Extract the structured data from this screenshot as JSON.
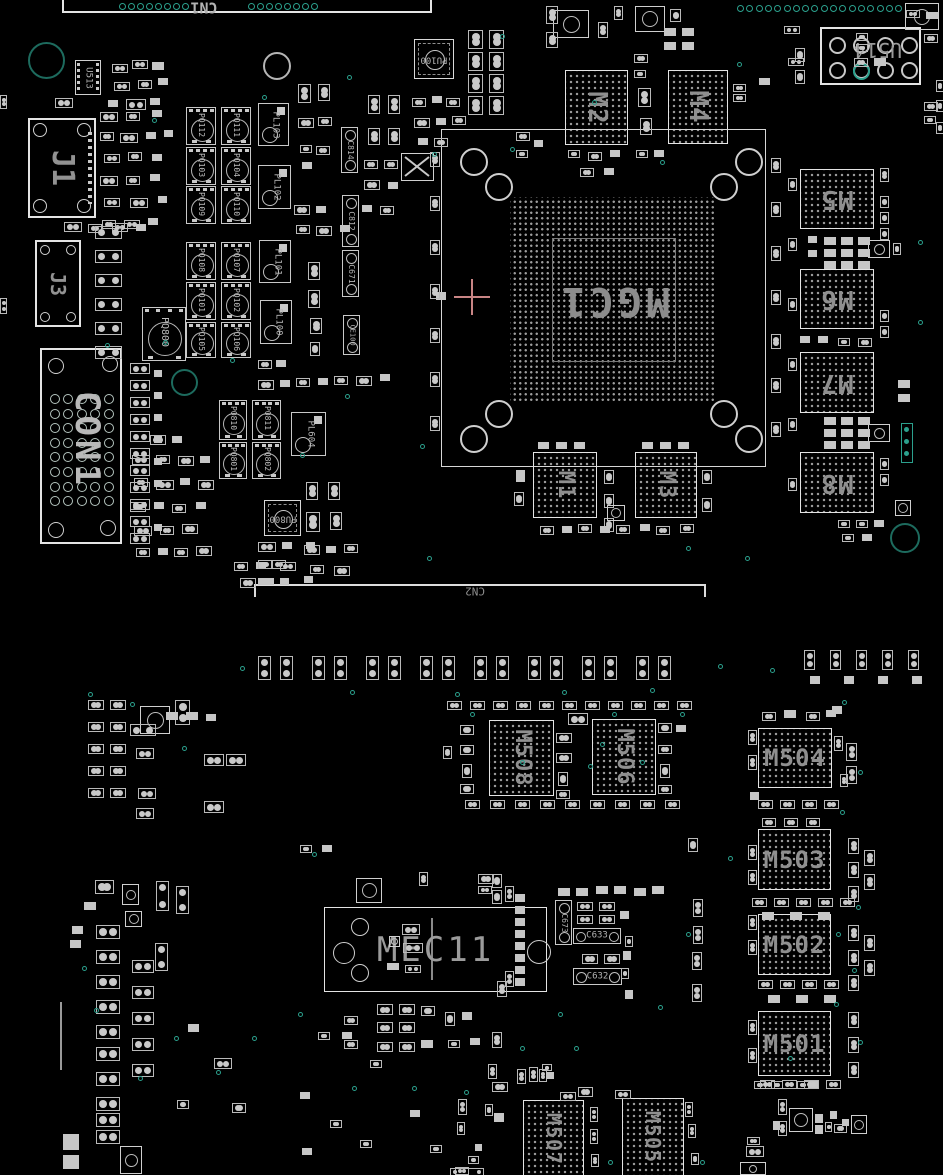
{
  "board": {
    "width": 943,
    "height": 1175,
    "description": "PCB boardview, black background, component outlines",
    "colors": {
      "background": "#000000",
      "outline": "#c8c8c8",
      "outline_bright": "#e4e4e4",
      "label": "#9a9a9a",
      "label_bright": "#b8b8b8",
      "pad_fill": "#c9c9c9",
      "bga_dot": "#9d9d9d",
      "teal": "#2ba08d",
      "teal_dim": "#1d6b5e",
      "crosshair": "#c98585"
    }
  },
  "components": [
    {
      "label": "CN1",
      "kind": "cn1"
    },
    {
      "label": "CN2",
      "kind": "cn2"
    },
    {
      "label": "U513",
      "kind": "soic",
      "x": 75,
      "y": 60,
      "w": 26,
      "h": 35,
      "rot": 90,
      "fs": 9
    },
    {
      "label": "J1",
      "kind": "jconn",
      "x": 28,
      "y": 118,
      "w": 68,
      "h": 100,
      "rot": 90,
      "fs": 30
    },
    {
      "label": "J3",
      "kind": "jconn",
      "x": 35,
      "y": 240,
      "w": 46,
      "h": 87,
      "rot": 90,
      "fs": 20
    },
    {
      "label": "CON1",
      "kind": "con1",
      "x": 40,
      "y": 348,
      "w": 82,
      "h": 196,
      "rot": 90,
      "fs": 34
    },
    {
      "label": "PU100",
      "kind": "qfn",
      "x": 414,
      "y": 39,
      "w": 40,
      "h": 40,
      "rot": 180,
      "fs": 9
    },
    {
      "label": "PQ112",
      "kind": "fet",
      "x": 186,
      "y": 107,
      "w": 30,
      "h": 38,
      "rot": 90,
      "fs": 8
    },
    {
      "label": "PQ111",
      "kind": "fet",
      "x": 221,
      "y": 107,
      "w": 30,
      "h": 38,
      "rot": 90,
      "fs": 8
    },
    {
      "label": "PQ103",
      "kind": "fet",
      "x": 186,
      "y": 147,
      "w": 30,
      "h": 38,
      "rot": 90,
      "fs": 8
    },
    {
      "label": "PQ104",
      "kind": "fet",
      "x": 221,
      "y": 147,
      "w": 30,
      "h": 38,
      "rot": 90,
      "fs": 8
    },
    {
      "label": "PQ109",
      "kind": "fet",
      "x": 186,
      "y": 186,
      "w": 30,
      "h": 38,
      "rot": 90,
      "fs": 8
    },
    {
      "label": "PQ110",
      "kind": "fet",
      "x": 221,
      "y": 186,
      "w": 30,
      "h": 38,
      "rot": 90,
      "fs": 8
    },
    {
      "label": "PQ108",
      "kind": "fet",
      "x": 186,
      "y": 242,
      "w": 30,
      "h": 38,
      "rot": 90,
      "fs": 8
    },
    {
      "label": "PQ107",
      "kind": "fet",
      "x": 221,
      "y": 242,
      "w": 30,
      "h": 38,
      "rot": 90,
      "fs": 8
    },
    {
      "label": "PQ101",
      "kind": "fet",
      "x": 186,
      "y": 282,
      "w": 30,
      "h": 38,
      "rot": 90,
      "fs": 8
    },
    {
      "label": "PQ102",
      "kind": "fet",
      "x": 221,
      "y": 282,
      "w": 30,
      "h": 38,
      "rot": 90,
      "fs": 8
    },
    {
      "label": "PQ105",
      "kind": "fet",
      "x": 186,
      "y": 322,
      "w": 30,
      "h": 36,
      "rot": 90,
      "fs": 8
    },
    {
      "label": "PQ106",
      "kind": "fet",
      "x": 221,
      "y": 322,
      "w": 30,
      "h": 36,
      "rot": 90,
      "fs": 8
    },
    {
      "label": "PL103",
      "kind": "ind",
      "x": 258,
      "y": 103,
      "w": 31,
      "h": 43,
      "rot": 90,
      "fs": 9
    },
    {
      "label": "PL102",
      "kind": "ind",
      "x": 258,
      "y": 165,
      "w": 33,
      "h": 44,
      "rot": 90,
      "fs": 9
    },
    {
      "label": "PL101",
      "kind": "ind",
      "x": 259,
      "y": 240,
      "w": 32,
      "h": 43,
      "rot": 90,
      "fs": 9
    },
    {
      "label": "PL100",
      "kind": "ind",
      "x": 260,
      "y": 300,
      "w": 32,
      "h": 44,
      "rot": 90,
      "fs": 9
    },
    {
      "label": "C814",
      "kind": "capv",
      "x": 341,
      "y": 127,
      "w": 17,
      "h": 46,
      "rot": 90,
      "fs": 8
    },
    {
      "label": "C812",
      "kind": "capv",
      "x": 342,
      "y": 195,
      "w": 17,
      "h": 52,
      "rot": 90,
      "fs": 8
    },
    {
      "label": "C671",
      "kind": "capv",
      "x": 342,
      "y": 250,
      "w": 17,
      "h": 47,
      "rot": 90,
      "fs": 8
    },
    {
      "label": "CE100",
      "kind": "capv",
      "x": 343,
      "y": 315,
      "w": 17,
      "h": 40,
      "rot": 90,
      "fs": 7
    },
    {
      "label": "PQ800",
      "kind": "fet",
      "x": 142,
      "y": 307,
      "w": 44,
      "h": 54,
      "rot": 90,
      "fs": 10
    },
    {
      "label": "PL604",
      "kind": "ind",
      "x": 291,
      "y": 412,
      "w": 35,
      "h": 44,
      "rot": 90,
      "fs": 9
    },
    {
      "label": "PQ810",
      "kind": "fet",
      "x": 219,
      "y": 400,
      "w": 28,
      "h": 40,
      "rot": 90,
      "fs": 8
    },
    {
      "label": "PQ811",
      "kind": "fet",
      "x": 252,
      "y": 400,
      "w": 29,
      "h": 40,
      "rot": 90,
      "fs": 8
    },
    {
      "label": "PQ801",
      "kind": "fet",
      "x": 219,
      "y": 442,
      "w": 28,
      "h": 37,
      "rot": 90,
      "fs": 8
    },
    {
      "label": "PQ802",
      "kind": "fet",
      "x": 252,
      "y": 442,
      "w": 29,
      "h": 37,
      "rot": 90,
      "fs": 8
    },
    {
      "label": "PU800",
      "kind": "qfn",
      "x": 264,
      "y": 500,
      "w": 37,
      "h": 36,
      "rot": 180,
      "fs": 9
    },
    {
      "label": "M2",
      "kind": "bga",
      "x": 565,
      "y": 70,
      "w": 63,
      "h": 75,
      "rot": 90,
      "fs": 26
    },
    {
      "label": "M4",
      "kind": "bga",
      "x": 668,
      "y": 70,
      "w": 60,
      "h": 74,
      "rot": 90,
      "fs": 26
    },
    {
      "label": "U514",
      "kind": "u514",
      "x": 820,
      "y": 27,
      "w": 101,
      "h": 58,
      "rot": 180,
      "fs": 20
    },
    {
      "label": "MGC1",
      "kind": "mgc",
      "x": 441,
      "y": 129,
      "w": 325,
      "h": 338,
      "rot": 180,
      "fs": 40
    },
    {
      "label": "M1",
      "kind": "bga",
      "x": 533,
      "y": 452,
      "w": 64,
      "h": 66,
      "rot": 90,
      "fs": 22
    },
    {
      "label": "M3",
      "kind": "bga",
      "x": 635,
      "y": 452,
      "w": 62,
      "h": 66,
      "rot": 90,
      "fs": 22
    },
    {
      "label": "M5",
      "kind": "bga",
      "x": 800,
      "y": 169,
      "w": 74,
      "h": 60,
      "rot": 180,
      "fs": 26
    },
    {
      "label": "M6",
      "kind": "bga",
      "x": 800,
      "y": 269,
      "w": 74,
      "h": 60,
      "rot": 180,
      "fs": 26
    },
    {
      "label": "M7",
      "kind": "bga",
      "x": 800,
      "y": 352,
      "w": 74,
      "h": 61,
      "rot": 180,
      "fs": 26
    },
    {
      "label": "M8",
      "kind": "bga",
      "x": 800,
      "y": 452,
      "w": 74,
      "h": 61,
      "rot": 180,
      "fs": 26
    },
    {
      "label": "M508",
      "kind": "bga",
      "x": 489,
      "y": 720,
      "w": 65,
      "h": 76,
      "rot": 90,
      "fs": 22
    },
    {
      "label": "M506",
      "kind": "bga",
      "x": 592,
      "y": 719,
      "w": 64,
      "h": 76,
      "rot": 90,
      "fs": 22
    },
    {
      "label": "M504",
      "kind": "bga",
      "x": 758,
      "y": 728,
      "w": 74,
      "h": 60,
      "rot": 0,
      "fs": 24
    },
    {
      "label": "M503",
      "kind": "bga",
      "x": 758,
      "y": 829,
      "w": 73,
      "h": 61,
      "rot": 0,
      "fs": 24
    },
    {
      "label": "M502",
      "kind": "bga",
      "x": 758,
      "y": 914,
      "w": 73,
      "h": 61,
      "rot": 0,
      "fs": 24
    },
    {
      "label": "M501",
      "kind": "bga",
      "x": 758,
      "y": 1011,
      "w": 73,
      "h": 65,
      "rot": 0,
      "fs": 24
    },
    {
      "label": "MEC11",
      "kind": "mec",
      "x": 324,
      "y": 907,
      "w": 223,
      "h": 85,
      "rot": 0,
      "fs": 34
    },
    {
      "label": "C673",
      "kind": "capv",
      "x": 555,
      "y": 900,
      "w": 17,
      "h": 45,
      "rot": 90,
      "fs": 8
    },
    {
      "label": "C633",
      "kind": "caph",
      "x": 573,
      "y": 928,
      "w": 48,
      "h": 16,
      "rot": 0,
      "fs": 9
    },
    {
      "label": "C632",
      "kind": "caph",
      "x": 573,
      "y": 968,
      "w": 49,
      "h": 17,
      "rot": 0,
      "fs": 9
    },
    {
      "label": "M507",
      "kind": "bga",
      "x": 523,
      "y": 1100,
      "w": 61,
      "h": 78,
      "rot": 90,
      "fs": 20
    },
    {
      "label": "M505",
      "kind": "bga",
      "x": 622,
      "y": 1098,
      "w": 62,
      "h": 78,
      "rot": 90,
      "fs": 20
    }
  ]
}
